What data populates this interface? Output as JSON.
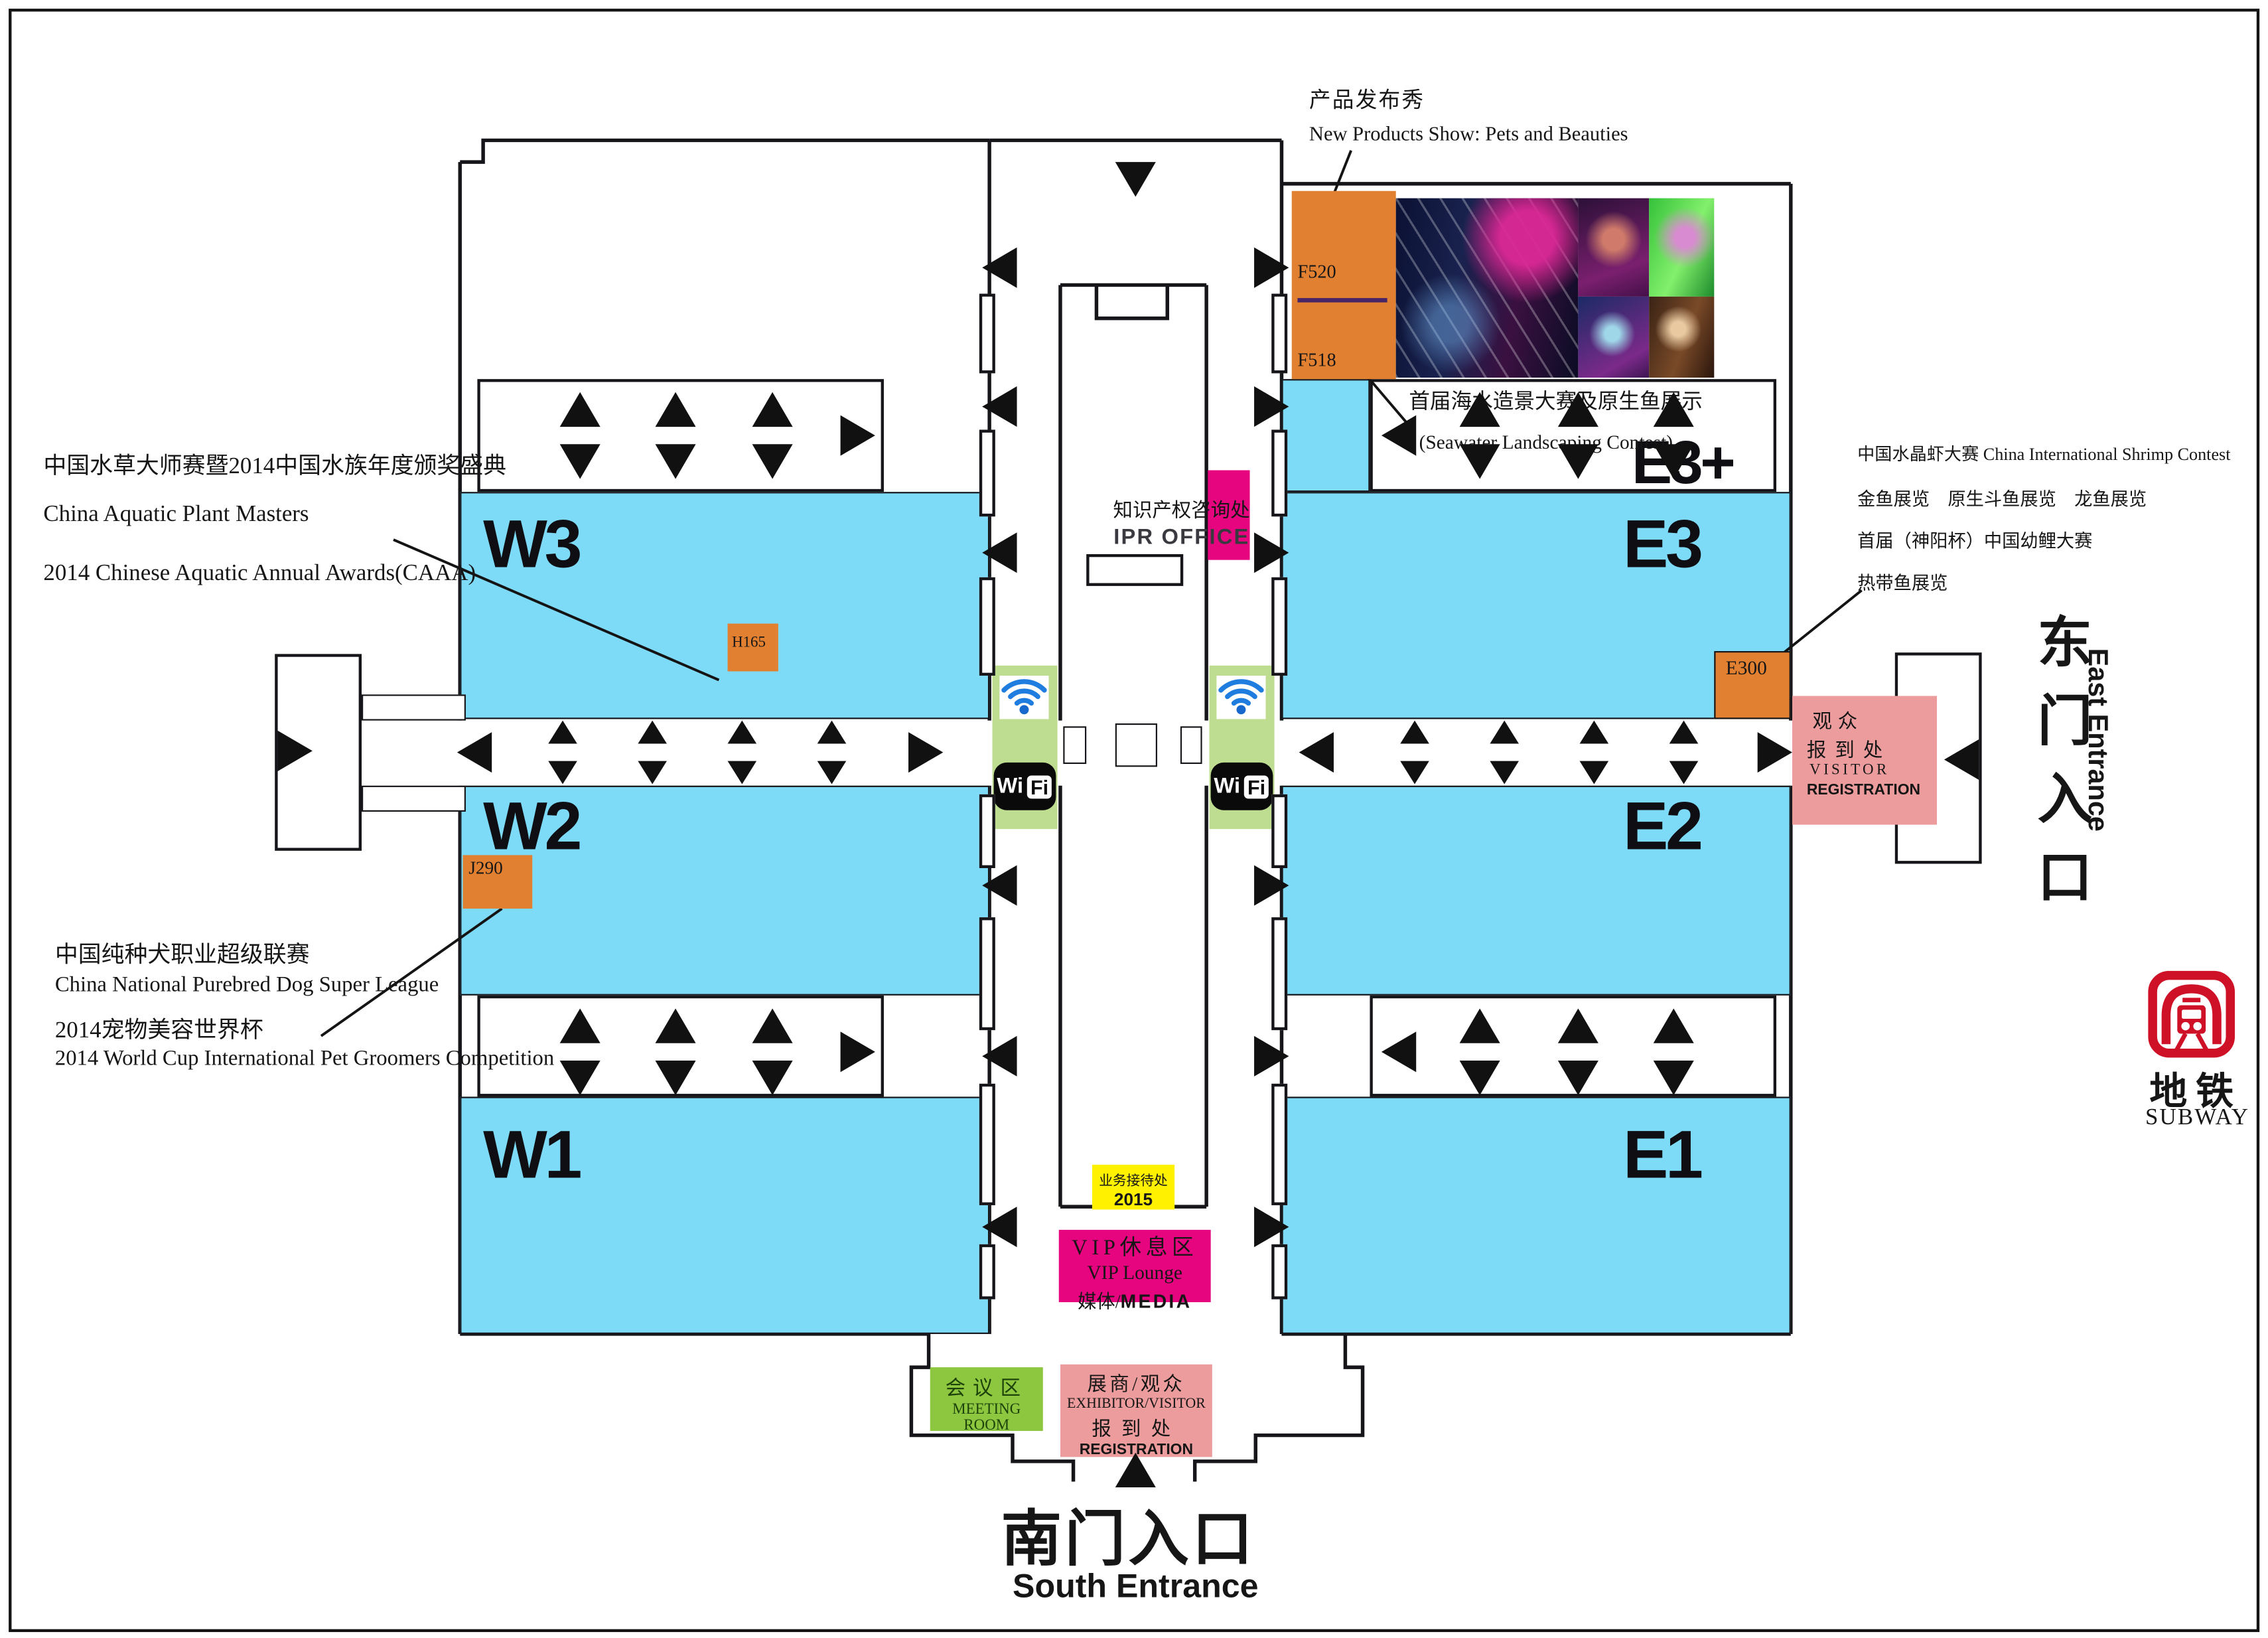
{
  "annotations": {
    "productShow": {
      "zh": "产品发布秀",
      "en": "New Products Show: Pets and Beauties"
    },
    "seawater": {
      "zh": "首届海水造景大赛及原生鱼展示",
      "en": "(Seawater Landscaping Contest)"
    },
    "e3plus": "E3+",
    "halls": {
      "w3": "W3",
      "w2": "W2",
      "w1": "W1",
      "e3": "E3",
      "e2": "E2",
      "e1": "E1"
    },
    "booths": {
      "f520": "F520",
      "f518": "F518",
      "h165": "H165",
      "j290": "J290",
      "e300": "E300"
    },
    "aquatic": {
      "zh": "中国水草大师赛暨2014中国水族年度颁奖盛典",
      "en1": "China Aquatic Plant Masters",
      "en2": "2014 Chinese Aquatic Annual Awards(CAAA)"
    },
    "shrimp": {
      "l1": "中国水晶虾大赛 China International Shrimp Contest",
      "l2": "金鱼展览　原生斗鱼展览　龙鱼展览",
      "l3": "首届（神阳杯）中国幼鲤大赛",
      "l4": "热带鱼展览"
    },
    "dog": {
      "zh1": "中国纯种犬职业超级联赛",
      "en1": "China National Purebred Dog Super League",
      "zh2": "2014宠物美容世界杯",
      "en2": "2014 World Cup International Pet Groomers Competition"
    },
    "ipr": {
      "zh": "知识产权咨询处",
      "en": "IPR OFFICE"
    },
    "service": {
      "zh": "业务接待处",
      "year": "2015"
    },
    "vip": {
      "zh": "VIP休息区",
      "en": "VIP Lounge",
      "mediaZh": "媒体/",
      "mediaEn": "MEDIA"
    },
    "meeting": {
      "zh": "会议区",
      "en": "MEETING ROOM"
    },
    "exhReg": {
      "l1": "展商/观众",
      "l2": "EXHIBITOR/VISITOR",
      "l3": "报到处",
      "l4": "REGISTRATION"
    },
    "visReg": {
      "l1": "观众",
      "l2": "报到处",
      "l3": "VISITOR",
      "l4": "REGISTRATION"
    },
    "south": {
      "zh": "南门入口",
      "en": "South Entrance"
    },
    "east": {
      "zh": "东门入口",
      "en": "East Entrance"
    },
    "subway": {
      "zh": "地铁",
      "en": "SUBWAY"
    },
    "wifi": {
      "wi": "Wi",
      "fi": "Fi"
    }
  },
  "colors": {
    "hallBlue": "#7EDBF7",
    "boothOrange": "#E08030",
    "magenta": "#E6057F",
    "registrationPink": "#EC9C9D",
    "serviceYellow": "#FFF100",
    "meetingGreen": "#8DC63F",
    "wifiGreen": "#BFDD90",
    "subwayRed": "#CE1126",
    "ink": "#161616"
  }
}
